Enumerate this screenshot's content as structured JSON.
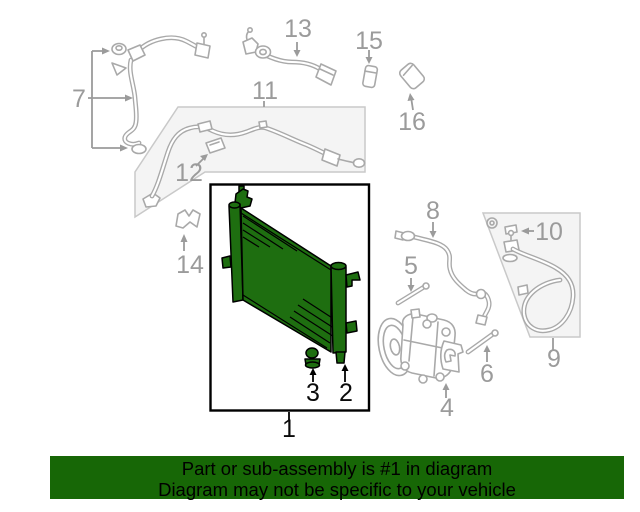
{
  "diagram": {
    "highlight_color": "#1e6e10",
    "line_color": "#a9a9a9",
    "panel_fill": "#f4f4f4",
    "callout_gray": "#9b9b9b",
    "callout_black": "#0a0a0a",
    "callouts": {
      "c1": {
        "label": "1"
      },
      "c2": {
        "label": "2"
      },
      "c3": {
        "label": "3"
      },
      "c4": {
        "label": "4"
      },
      "c5": {
        "label": "5"
      },
      "c6": {
        "label": "6"
      },
      "c7": {
        "label": "7"
      },
      "c8": {
        "label": "8"
      },
      "c9": {
        "label": "9"
      },
      "c10": {
        "label": "10"
      },
      "c11": {
        "label": "11"
      },
      "c12": {
        "label": "12"
      },
      "c13": {
        "label": "13"
      },
      "c14": {
        "label": "14"
      },
      "c15": {
        "label": "15"
      },
      "c16": {
        "label": "16"
      }
    }
  },
  "banner": {
    "line1": "Part or sub-assembly is #1 in diagram",
    "line2": "Diagram may not be specific to your vehicle",
    "background": "#176706",
    "text_color": "#000000"
  }
}
